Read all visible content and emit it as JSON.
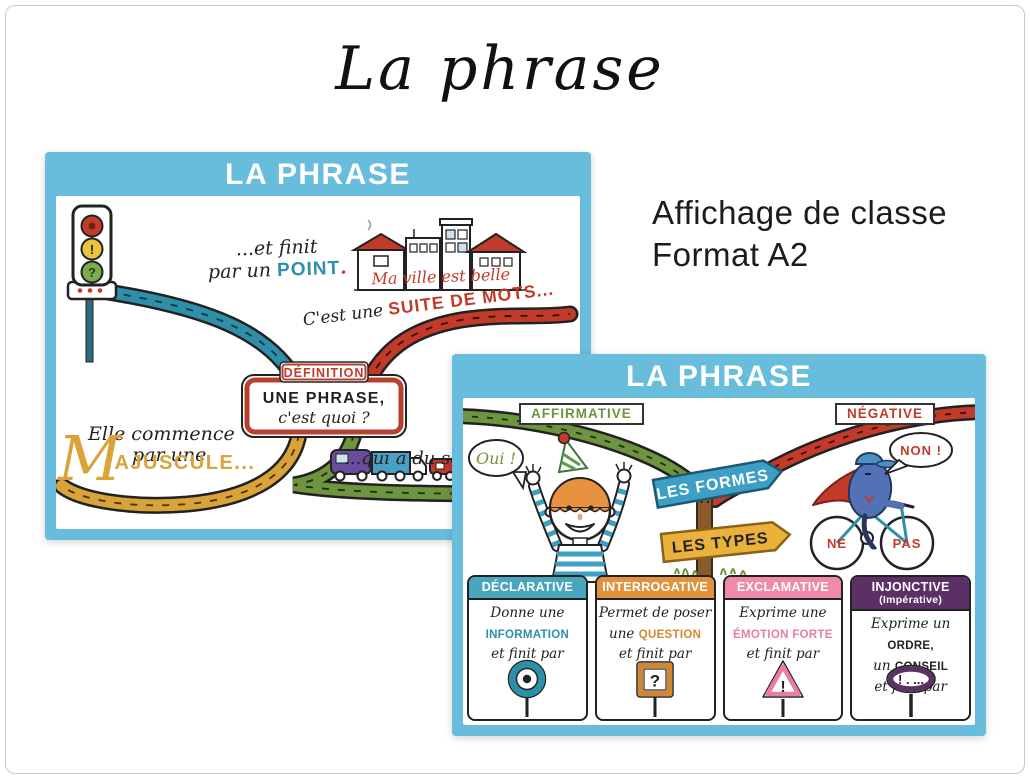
{
  "page": {
    "title": "La phrase",
    "caption_line1": "Affichage de classe",
    "caption_line2": "Format A2"
  },
  "poster_simple": {
    "header": "LA PHRASE",
    "finit_line1": "...et finit",
    "finit_line2_pre": "par un ",
    "finit_word": "POINT",
    "finit_period": ".",
    "light_exclamation": "!",
    "light_question": "?",
    "ville_text": "Ma ville est belle",
    "suite_pre": "C'est une ",
    "suite_word": "SUITE DE MOTS...",
    "definition_label": "DÉFINITION",
    "definition_line1": "UNE PHRASE,",
    "definition_line2": "c'est quoi ?",
    "commence_line1": "Elle commence",
    "commence_line2": "par une",
    "majuscule_initial": "M",
    "majuscule_rest": "AJUSCULE...",
    "sens_text": "...qui a du sens"
  },
  "poster_types": {
    "header": "LA PHRASE",
    "affirmative_label": "AFFIRMATIVE",
    "negative_label": "NÉGATIVE",
    "oui_bubble": "Oui !",
    "non_bubble": "NON !",
    "wheel_ne": "NE",
    "wheel_pas": "PAS",
    "sign_formes": "LES FORMES",
    "sign_types": "LES TYPES",
    "cards": [
      {
        "title": "DÉCLARATIVE",
        "subtitle": "",
        "header_color": "#4aa6bd",
        "emph_color": "#2e8fa8",
        "lines": [
          {
            "p": "Donne une",
            "e": ""
          },
          {
            "p": "",
            "e": "INFORMATION"
          },
          {
            "p": "et finit par",
            "e": ""
          }
        ],
        "sign": "period-circle",
        "glyph": ""
      },
      {
        "title": "INTERROGATIVE",
        "subtitle": "",
        "header_color": "#e2913d",
        "emph_color": "#d4872f",
        "lines": [
          {
            "p": "Permet de poser",
            "e": ""
          },
          {
            "p": "une ",
            "e": "QUESTION"
          },
          {
            "p": "et finit par",
            "e": ""
          }
        ],
        "sign": "question-square",
        "glyph": "?"
      },
      {
        "title": "EXCLAMATIVE",
        "subtitle": "",
        "header_color": "#ef8ba6",
        "emph_color": "#e87f9d",
        "lines": [
          {
            "p": "Exprime une",
            "e": ""
          },
          {
            "p": "",
            "e": "ÉMOTION FORTE"
          },
          {
            "p": "et finit par",
            "e": ""
          }
        ],
        "sign": "exclamation-triangle",
        "glyph": "!"
      },
      {
        "title": "INJONCTIVE",
        "subtitle": "(Impérative)",
        "header_color": "#5c2f66",
        "emph_color": "#222222",
        "lines": [
          {
            "p": "Exprime un ",
            "e": "ORDRE,"
          },
          {
            "p": "un ",
            "e": "CONSEIL"
          },
          {
            "p": "et finit par",
            "e": ""
          }
        ],
        "sign": "imperative-oval",
        "glyph": "! . ..."
      }
    ]
  },
  "colors": {
    "poster_frame_blue": "#68bcdc",
    "teal": "#2e8fa8",
    "red": "#c23b2a",
    "gold": "#d9a33a",
    "green": "#6f9440",
    "orange": "#e2913d",
    "pink": "#ef8ba6",
    "purple": "#5c2f66",
    "sign_blue": "#3d9fc4",
    "sign_yellow": "#eab23b"
  }
}
